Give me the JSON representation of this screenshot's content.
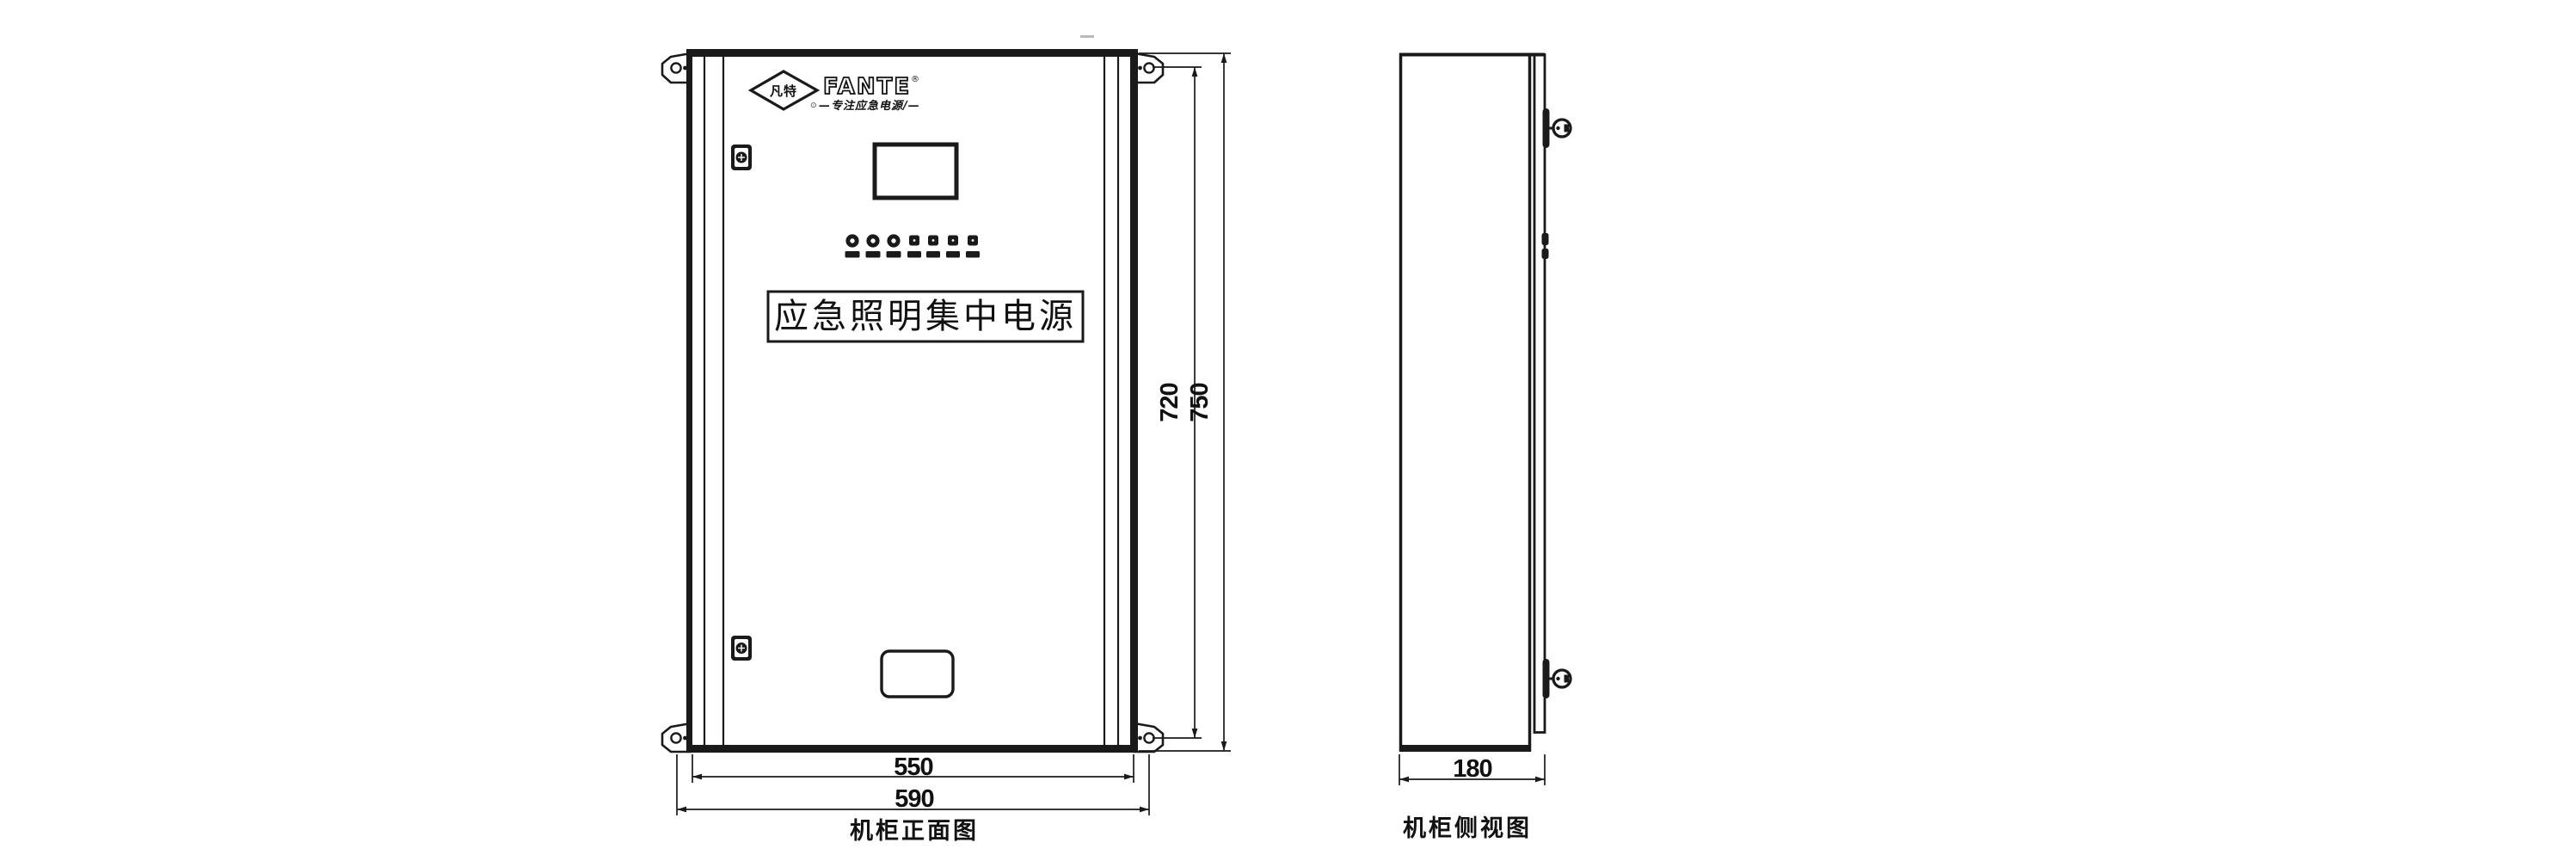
{
  "drawing": {
    "colors": {
      "line": "#1a1a1a",
      "background": "#ffffff"
    },
    "front_view": {
      "title": "机柜正面图",
      "logo": {
        "mark_text": "凡特",
        "brand": "FANTE",
        "registered_mark": "®",
        "slogan_bullet": "⊙",
        "slogan": "—专注应急电源/—"
      },
      "nameplate_text": "应急照明集中电源",
      "dims": {
        "body_width": "550",
        "overall_width": "590",
        "mounting_height": "720",
        "overall_height": "750"
      }
    },
    "side_view": {
      "title": "机柜侧视图",
      "dims": {
        "depth": "180"
      }
    }
  }
}
